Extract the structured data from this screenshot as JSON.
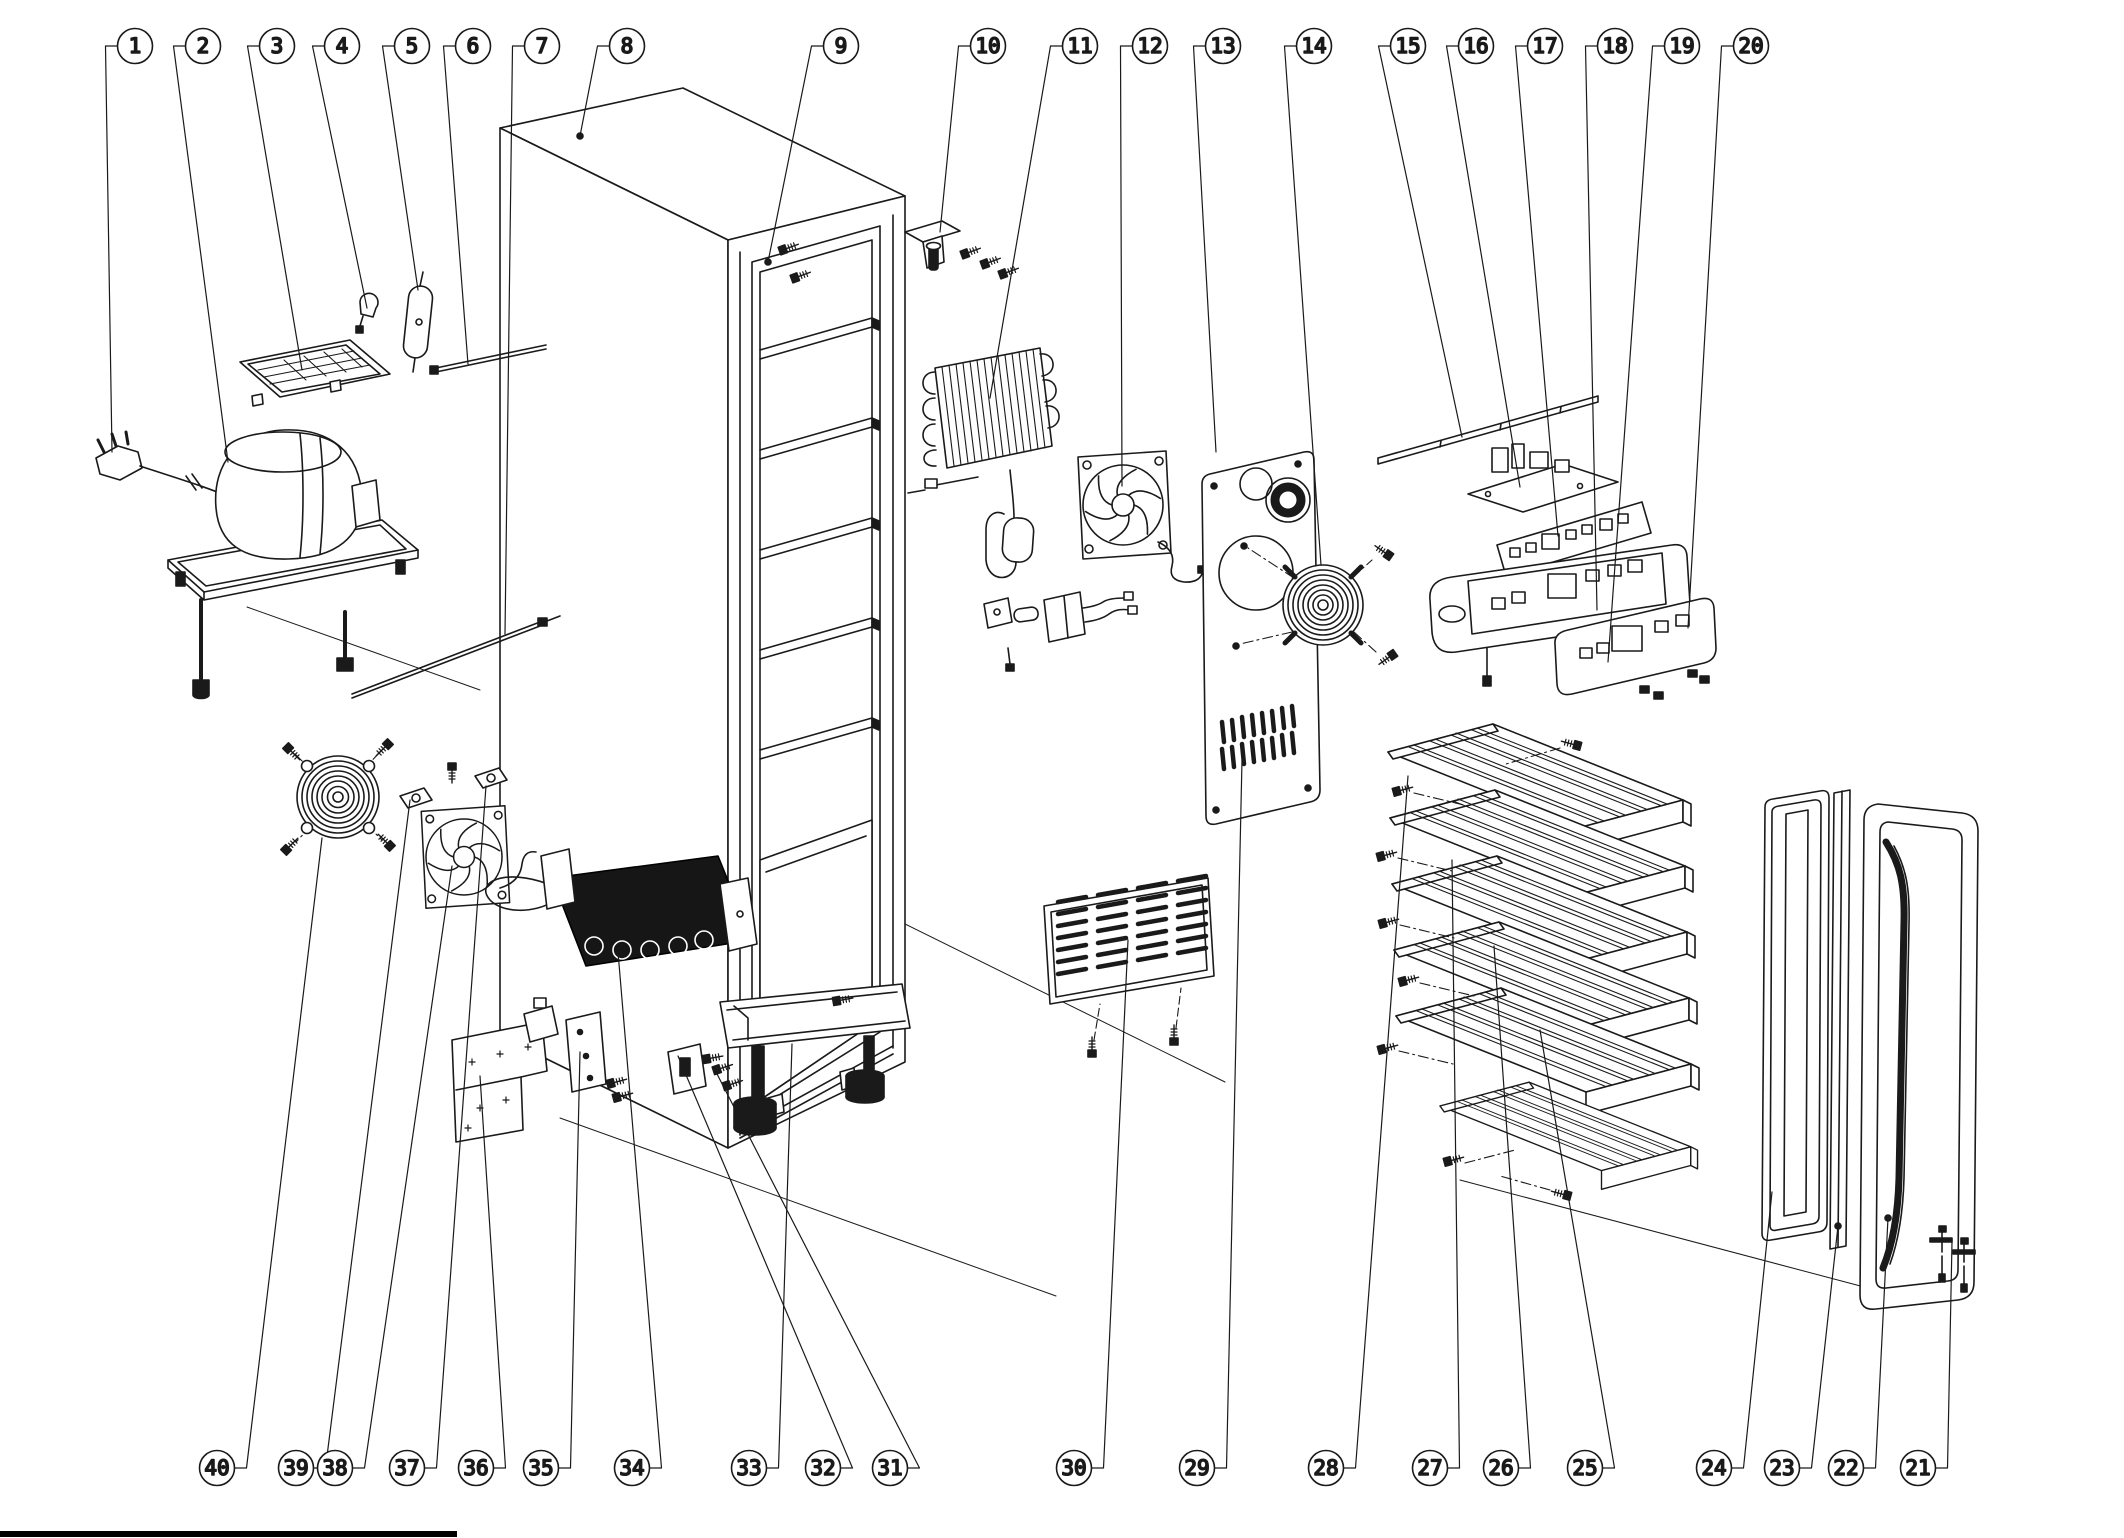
{
  "callout_style": {
    "radius": 17.5,
    "color": "#1a1a1a",
    "font_size": 21
  },
  "callouts": {
    "top": [
      {
        "label": "1",
        "cx": 135,
        "cy": 46,
        "tx": 112,
        "ty": 452
      },
      {
        "label": "2",
        "cx": 203,
        "cy": 46,
        "tx": 228,
        "ty": 462
      },
      {
        "label": "3",
        "cx": 277,
        "cy": 46,
        "tx": 302,
        "ty": 370
      },
      {
        "label": "4",
        "cx": 342,
        "cy": 46,
        "tx": 367,
        "ty": 308
      },
      {
        "label": "5",
        "cx": 412,
        "cy": 46,
        "tx": 418,
        "ty": 290
      },
      {
        "label": "6",
        "cx": 473,
        "cy": 46,
        "tx": 468,
        "ty": 364
      },
      {
        "label": "7",
        "cx": 542,
        "cy": 46,
        "tx": 505,
        "ty": 634
      },
      {
        "label": "8",
        "cx": 627,
        "cy": 46,
        "tx": 580,
        "ty": 136
      },
      {
        "label": "9",
        "cx": 841,
        "cy": 46,
        "tx": 768,
        "ty": 262
      },
      {
        "label": "10",
        "cx": 988,
        "cy": 46,
        "tx": 940,
        "ty": 232
      },
      {
        "label": "11",
        "cx": 1080,
        "cy": 46,
        "tx": 990,
        "ty": 398
      },
      {
        "label": "12",
        "cx": 1150,
        "cy": 46,
        "tx": 1122,
        "ty": 486
      },
      {
        "label": "13",
        "cx": 1223,
        "cy": 46,
        "tx": 1216,
        "ty": 452
      },
      {
        "label": "14",
        "cx": 1314,
        "cy": 46,
        "tx": 1321,
        "ty": 565
      },
      {
        "label": "15",
        "cx": 1408,
        "cy": 46,
        "tx": 1462,
        "ty": 437
      },
      {
        "label": "16",
        "cx": 1476,
        "cy": 46,
        "tx": 1520,
        "ty": 487
      },
      {
        "label": "17",
        "cx": 1545,
        "cy": 46,
        "tx": 1558,
        "ty": 536
      },
      {
        "label": "18",
        "cx": 1615,
        "cy": 46,
        "tx": 1597,
        "ty": 610
      },
      {
        "label": "19",
        "cx": 1682,
        "cy": 46,
        "tx": 1608,
        "ty": 662
      },
      {
        "label": "20",
        "cx": 1751,
        "cy": 46,
        "tx": 1688,
        "ty": 628
      }
    ],
    "bottom": [
      {
        "label": "40",
        "cx": 217,
        "cy": 1468,
        "tx": 322,
        "ty": 838
      },
      {
        "label": "39",
        "cx": 296,
        "cy": 1468,
        "tx": 410,
        "ty": 800
      },
      {
        "label": "38",
        "cx": 335,
        "cy": 1468,
        "tx": 452,
        "ty": 866
      },
      {
        "label": "37",
        "cx": 407,
        "cy": 1468,
        "tx": 486,
        "ty": 786
      },
      {
        "label": "36",
        "cx": 476,
        "cy": 1468,
        "tx": 480,
        "ty": 1076
      },
      {
        "label": "35",
        "cx": 541,
        "cy": 1468,
        "tx": 580,
        "ty": 1052
      },
      {
        "label": "34",
        "cx": 632,
        "cy": 1468,
        "tx": 618,
        "ty": 952
      },
      {
        "label": "33",
        "cx": 749,
        "cy": 1468,
        "tx": 792,
        "ty": 1044
      },
      {
        "label": "32",
        "cx": 823,
        "cy": 1468,
        "tx": 678,
        "ty": 1056
      },
      {
        "label": "31",
        "cx": 890,
        "cy": 1468,
        "tx": 716,
        "ty": 1072
      },
      {
        "label": "30",
        "cx": 1074,
        "cy": 1468,
        "tx": 1128,
        "ty": 940
      },
      {
        "label": "29",
        "cx": 1197,
        "cy": 1468,
        "tx": 1242,
        "ty": 760
      },
      {
        "label": "28",
        "cx": 1326,
        "cy": 1468,
        "tx": 1408,
        "ty": 776
      },
      {
        "label": "27",
        "cx": 1430,
        "cy": 1468,
        "tx": 1452,
        "ty": 860
      },
      {
        "label": "26",
        "cx": 1501,
        "cy": 1468,
        "tx": 1494,
        "ty": 946
      },
      {
        "label": "25",
        "cx": 1585,
        "cy": 1468,
        "tx": 1540,
        "ty": 1030
      },
      {
        "label": "24",
        "cx": 1714,
        "cy": 1468,
        "tx": 1772,
        "ty": 1192
      },
      {
        "label": "23",
        "cx": 1782,
        "cy": 1468,
        "tx": 1838,
        "ty": 1226
      },
      {
        "label": "22",
        "cx": 1846,
        "cy": 1468,
        "tx": 1888,
        "ty": 1218
      },
      {
        "label": "21",
        "cx": 1918,
        "cy": 1468,
        "tx": 1952,
        "ty": 1242
      }
    ]
  }
}
